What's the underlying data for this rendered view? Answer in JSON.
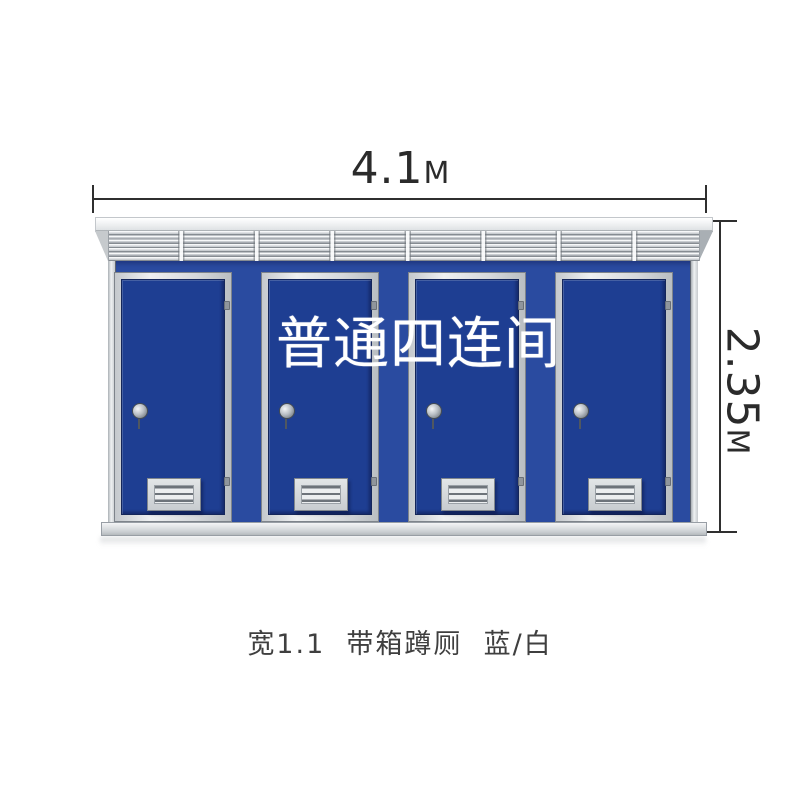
{
  "page": {
    "background": "#ffffff"
  },
  "annotations": {
    "width_dim": {
      "value": "4.1",
      "unit": "M"
    },
    "height_dim": {
      "value": "2.35",
      "unit": "M"
    },
    "line_color": "#2f2f2f"
  },
  "overlay": {
    "title": "普通四连间",
    "color": "#ffffff"
  },
  "caption": {
    "text": "宽1.1  带箱蹲厕  蓝/白",
    "color": "#3f3f3f"
  },
  "building": {
    "description": "four-unit portable squat toilet block, blue/white",
    "unit_count": 4,
    "colors": {
      "door_blue": "#1e3e92",
      "panel_blue": "#2a4ba0",
      "frame_silver": "#d9dcdf",
      "roof_white": "#f7f8f9",
      "vent_gray": "#cfd3d6",
      "base_gray": "#cdd1d4"
    }
  }
}
